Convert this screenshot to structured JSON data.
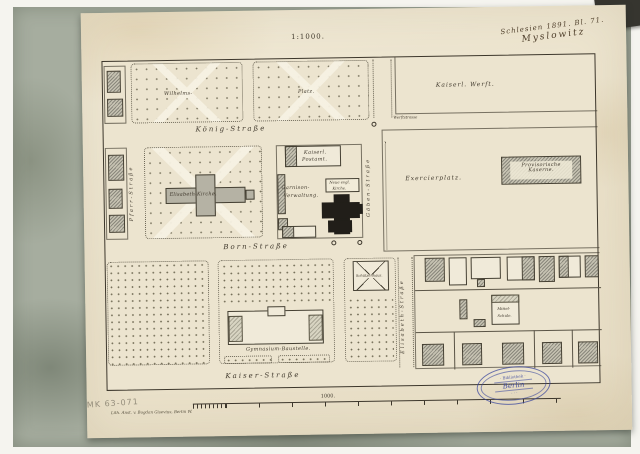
{
  "annotations": {
    "archive_series": "Schlesien 1891. Bl. 71.",
    "archive_place": "Myslowitz",
    "scale_heading": "1:1000.",
    "pencil_code": "MK 63-071",
    "imprint": "Lith. Anst. v. Bogdan Gisevius, Berlin W.",
    "scalebar_label": "1000."
  },
  "streets": {
    "koenig": "König-Straße",
    "born": "Born-Straße",
    "kaiser": "Kaiser-Straße",
    "pfarr": "Pfarr-Straße",
    "goeben": "Göben-Straße",
    "elisabeth": "Elisabeth-Straße",
    "werft": "Werftstrasse"
  },
  "places": {
    "wilhelms": "Wilhelms-",
    "platz": "Platz.",
    "kaiserl_werft": "Kaiserl. Werft.",
    "exercierplatz": "Exercierplatz.",
    "kaserne_line1": "Provisorische",
    "kaserne_line2": "Kaserne.",
    "kirche": "Elisabeth-Kirche.",
    "postamt_line1": "Kaiserl.",
    "postamt_line2": "Postamt.",
    "garnison_line1": "Garnison-",
    "garnison_line2": "Verwaltung.",
    "neue_kirche_line1": "Neue evgl.",
    "neue_kirche_line2": "Kirche.",
    "schuetzenhaus": "Schützenhaus.",
    "baustelle": "Gymnasium-Baustelle.",
    "mittelschule_line1": "Mittel-",
    "mittelschule_line2": "Schule."
  },
  "stamp": {
    "top": "· Bibliothek ·",
    "center": "Berlin",
    "bottom": "· · ·"
  }
}
